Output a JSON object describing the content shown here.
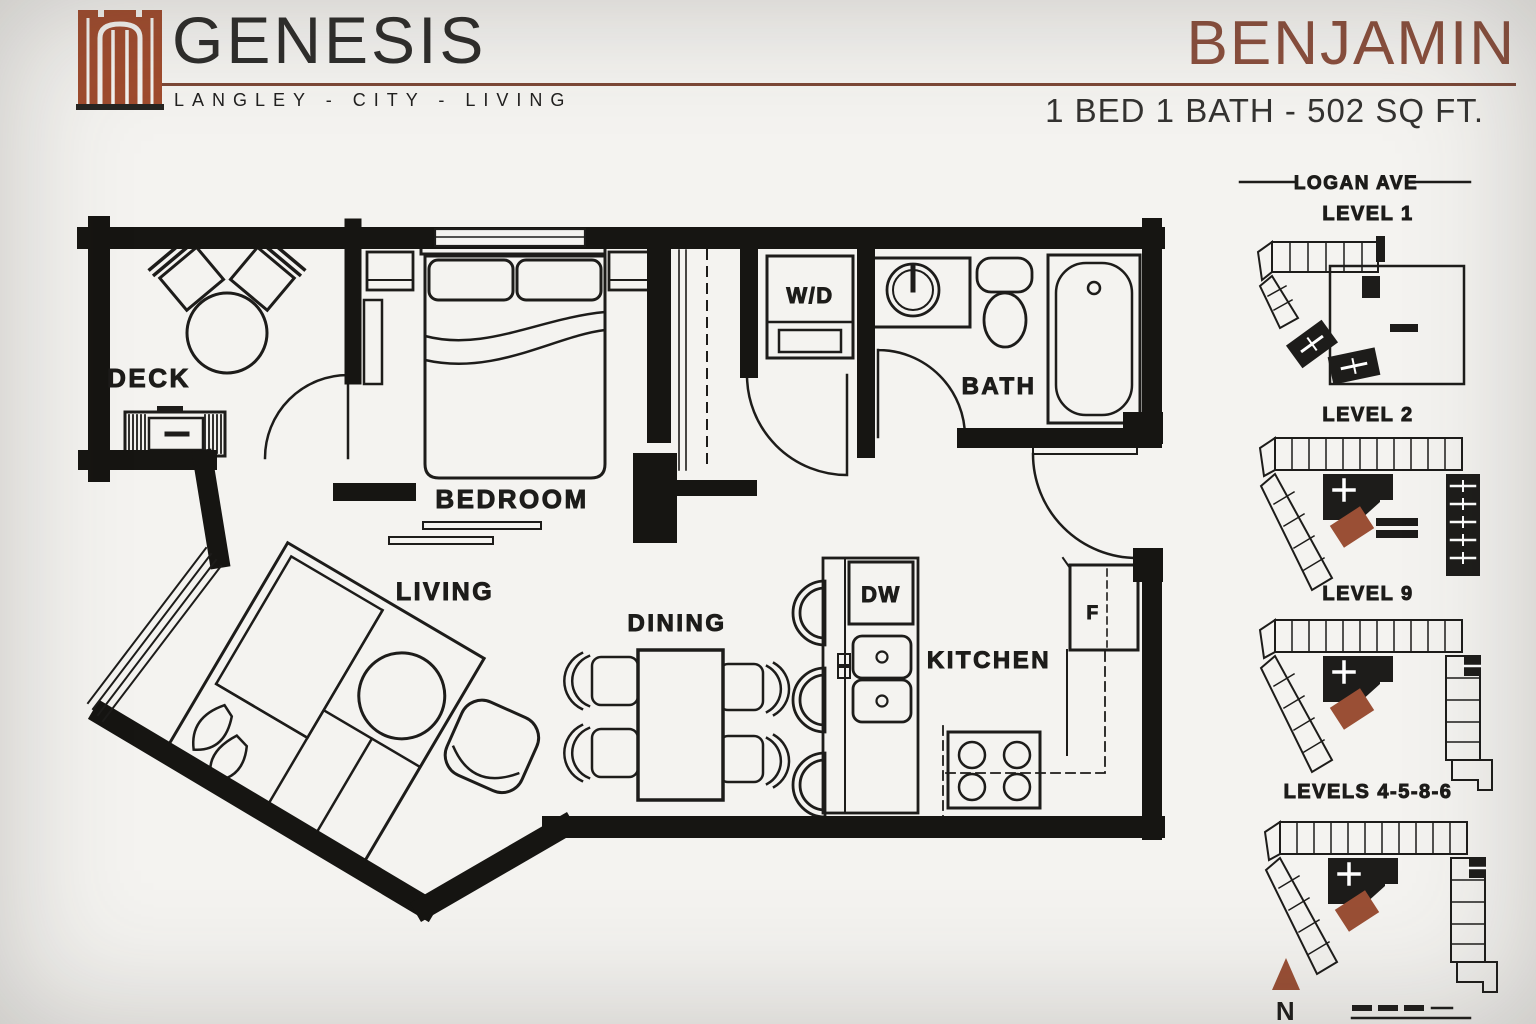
{
  "header": {
    "brand": {
      "name": "GENESIS",
      "tagline": "LANGLEY - CITY - LIVING"
    },
    "unit": {
      "name": "BENJAMIN",
      "specs": "1 BED  1 BATH - 502 SQ FT."
    }
  },
  "floorplan": {
    "rooms": {
      "deck": "DECK",
      "bedroom": "BEDROOM",
      "bath": "BATH",
      "living": "LIVING",
      "dining": "DINING",
      "kitchen": "KITCHEN"
    },
    "appliances": {
      "washer_dryer": "W/D",
      "dishwasher": "DW",
      "fridge": "F"
    }
  },
  "keyplans": {
    "street": "LOGAN AVE",
    "levels": [
      {
        "label": "LEVEL 1"
      },
      {
        "label": "LEVEL 2"
      },
      {
        "label": "LEVEL 9"
      },
      {
        "label": "LEVELS 4-5-8-6"
      }
    ],
    "north_label": "N"
  },
  "colors": {
    "accent": "#9a4f35",
    "title": "#8a4f3d",
    "ink": "#1d1c1a",
    "background": "#f4f3f0"
  }
}
